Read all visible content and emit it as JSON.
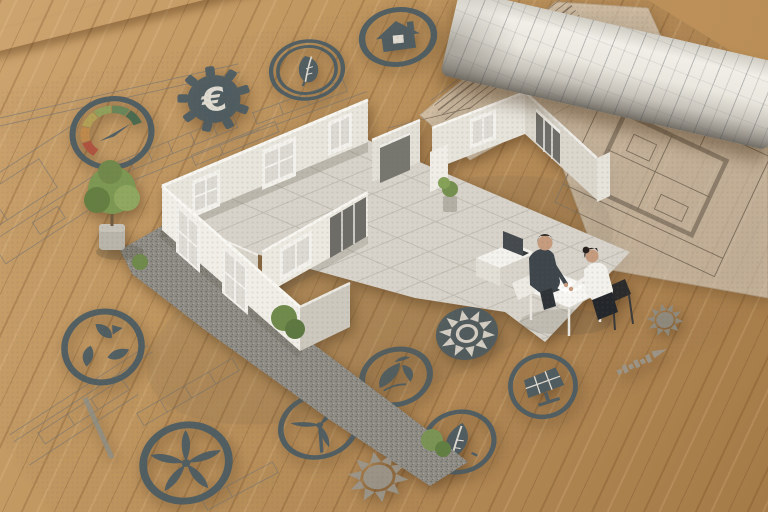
{
  "scene": {
    "objects": {
      "paper_sheet": "architectural blueprint sheet",
      "pencil": "wooden dowel pencil",
      "blueprint_roll": "rolled-up blueprint",
      "house_model": "miniature open-top house model",
      "miniature_man": "man in dark suit at table",
      "miniature_woman": "woman in white top on black chair",
      "table": "white meeting table",
      "laptop": "laptop on white sideboard",
      "potted_tree": "small potted tree",
      "bushes": "green bushes",
      "gravel": "gravel border",
      "tiles": "tiled courtyard floor"
    }
  },
  "colors": {
    "icon_slate": "#4a5b63",
    "icon_gray": "#9b978c",
    "paper": "#e8e5de",
    "wood": "#b98e58",
    "wall_light": "#efede6",
    "wall_dark": "#ccc8be",
    "gauge_segments": [
      "#b0503e",
      "#c08b4b",
      "#b3a355",
      "#8fa35c",
      "#64865a",
      "#43684e"
    ]
  },
  "icons": [
    {
      "name": "energy-gauge-icon",
      "type": "gauge",
      "x": 112,
      "y": 133,
      "w": 88,
      "h": 76,
      "rot": -10
    },
    {
      "name": "gear-euro-icon",
      "type": "gear",
      "x": 214,
      "y": 99,
      "w": 78,
      "h": 70,
      "rot": -8,
      "glyph": "€"
    },
    {
      "name": "leaf-badge-icon",
      "type": "leafRings",
      "x": 307,
      "y": 70,
      "w": 80,
      "h": 64,
      "rot": -8
    },
    {
      "name": "house-badge-icon",
      "type": "houseRing",
      "x": 398,
      "y": 37,
      "w": 82,
      "h": 62,
      "rot": -8
    },
    {
      "name": "recycle-leaves-icon",
      "type": "recycle",
      "x": 103,
      "y": 347,
      "w": 88,
      "h": 80,
      "rot": -14
    },
    {
      "name": "wind-fan-icon",
      "type": "wind5",
      "x": 186,
      "y": 463,
      "w": 98,
      "h": 86,
      "rot": -14
    },
    {
      "name": "wind-turbine-icon",
      "type": "wind3",
      "x": 319,
      "y": 426,
      "w": 88,
      "h": 70,
      "rot": -16
    },
    {
      "name": "eco-globe-icon",
      "type": "globe",
      "x": 396,
      "y": 377,
      "w": 78,
      "h": 62,
      "rot": -16
    },
    {
      "name": "sun-badge-icon",
      "type": "sunInverse",
      "x": 467,
      "y": 333,
      "w": 68,
      "h": 57,
      "rot": -12
    },
    {
      "name": "leaf-ring-icon",
      "type": "leafRing",
      "x": 459,
      "y": 442,
      "w": 80,
      "h": 68,
      "rot": -14
    },
    {
      "name": "solar-panel-icon",
      "type": "solar",
      "x": 543,
      "y": 386,
      "w": 74,
      "h": 70,
      "rot": -12
    },
    {
      "name": "sun-gray-icon",
      "type": "sunGray",
      "x": 378,
      "y": 477,
      "w": 70,
      "h": 58,
      "rot": -10,
      "color": "#9b978c"
    },
    {
      "name": "sun-line-icon",
      "type": "sunGray",
      "x": 665,
      "y": 320,
      "w": 42,
      "h": 38,
      "rot": -12,
      "color": "#8f8c82"
    },
    {
      "name": "scale-bar-icon",
      "type": "scaleBar",
      "x": 643,
      "y": 361,
      "w": 64,
      "h": 34,
      "rot": -24,
      "color": "#9b978c"
    }
  ]
}
